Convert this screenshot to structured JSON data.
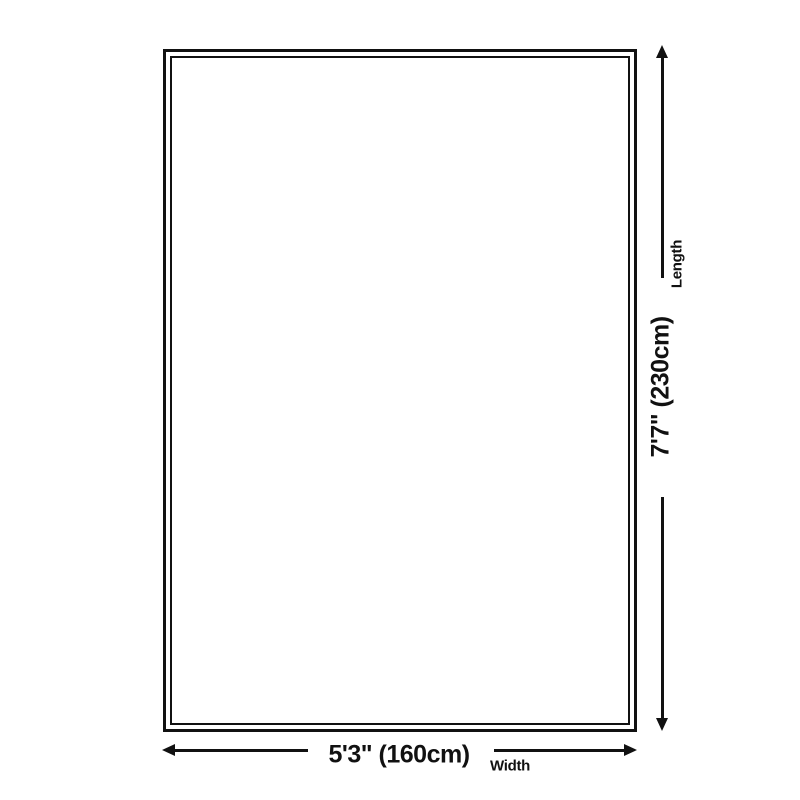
{
  "diagram": {
    "background_color": "#ffffff",
    "line_color": "#111111",
    "length_dimension": {
      "value": "7'7\" (230cm)",
      "label": "Length"
    },
    "width_dimension": {
      "value": "5'3\" (160cm)",
      "label": "Width"
    }
  }
}
